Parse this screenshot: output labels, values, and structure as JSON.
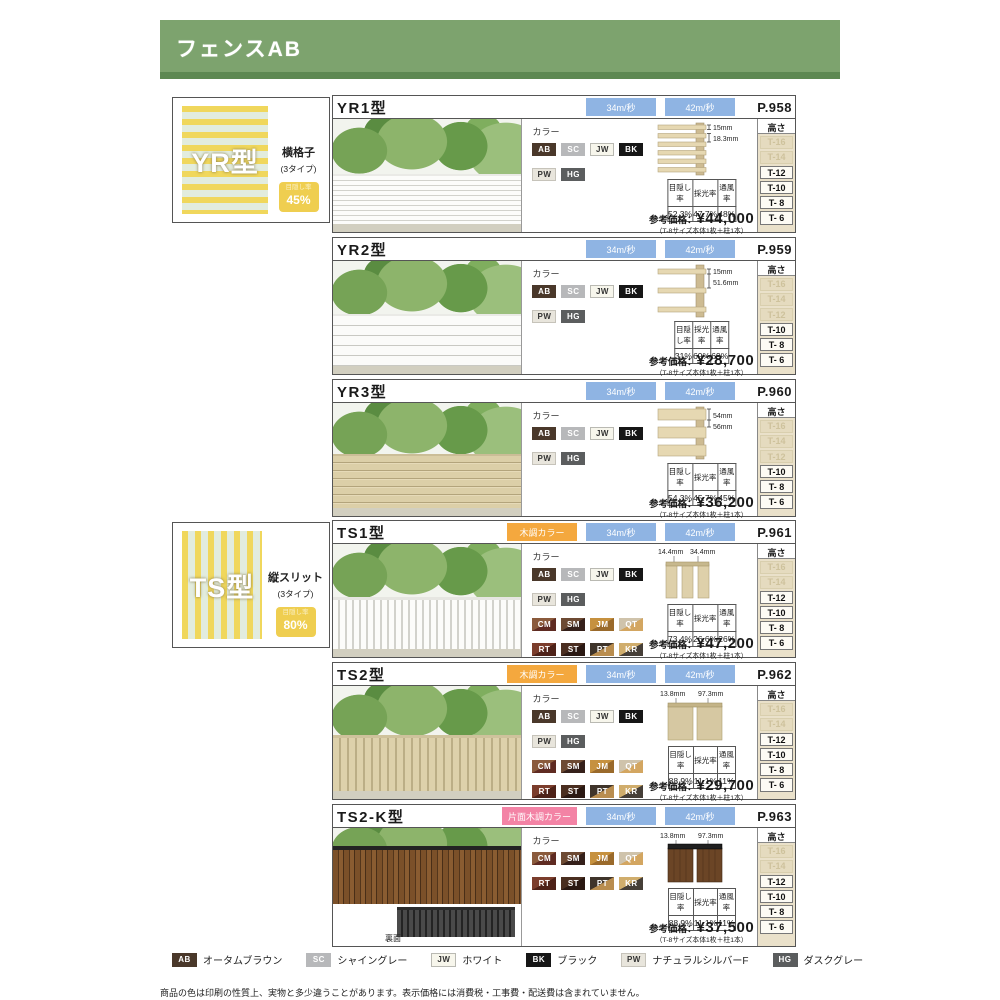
{
  "header": {
    "title": "フェンスAB"
  },
  "labels": {
    "color": "カラー",
    "height": "高さ",
    "price_label": "参考価格：",
    "price_note": "（T-8サイズ本体1枚＋柱1本）",
    "stats_headers": [
      "目隠し率",
      "採光率",
      "通風率"
    ],
    "back_label": "裏面"
  },
  "palette": {
    "banner_green": "#7da36e",
    "banner_green_dark": "#5d8852",
    "badge_blue": "#8fb4e3",
    "badge_orange": "#f4a83e",
    "badge_pink": "#f383a5",
    "rate_badge_yellow": "#efce50",
    "stripe_yellow": "#f0d75c",
    "stripe_mint": "#e2ecde",
    "height_col_beige": "#eae1ca"
  },
  "swatch_colors": {
    "AB": {
      "c1": "#4a382a",
      "text": "#ffffff"
    },
    "SC": {
      "c1": "#b7b8ba",
      "text": "#ffffff"
    },
    "JW": {
      "c1": "#f7f6ec",
      "text": "#333333",
      "border": "#b9b9b2"
    },
    "BK": {
      "c1": "#161616",
      "text": "#ffffff"
    },
    "PW": {
      "c1": "#e8e5dc",
      "text": "#333333",
      "border": "#c6c3ba"
    },
    "HG": {
      "c1": "#5b5d5e",
      "text": "#ffffff"
    },
    "CM": {
      "c1": "#8a5a3c",
      "c2": "#5f2b22",
      "text": "#ffffff"
    },
    "SM": {
      "c1": "#6d4a33",
      "c2": "#35201a",
      "text": "#ffffff"
    },
    "JM": {
      "c1": "#c6913f",
      "c2": "#9a6a2b",
      "text": "#ffffff"
    },
    "QT": {
      "c1": "#cfc3ab",
      "c2": "#d3a661",
      "text": "#ffffff"
    },
    "RT": {
      "c1": "#7b3d2c",
      "c2": "#4e2218",
      "text": "#ffffff"
    },
    "ST": {
      "c1": "#4a2e20",
      "c2": "#2a1812",
      "text": "#ffffff"
    },
    "PT": {
      "c1": "#3f342a",
      "c2": "#b98d4f",
      "text": "#ffffff"
    },
    "KR": {
      "c1": "#d0ad6c",
      "c2": "#463f38",
      "text": "#ffffff"
    }
  },
  "sections": [
    {
      "emblem": "YR型",
      "type_label": "横格子",
      "type_count": "(3タイプ)",
      "badge_title": "目隠し率",
      "badge_value": "45%"
    },
    {
      "emblem": "TS型",
      "type_label": "縦スリット",
      "type_count": "(3タイプ)",
      "badge_title": "目隠し率",
      "badge_value": "80%"
    }
  ],
  "rows": [
    {
      "model": "YR1型",
      "page": "P.958",
      "badges": [
        {
          "text": "34m/秒"
        },
        {
          "text": "42m/秒"
        }
      ],
      "swatches": [
        "AB",
        "SC",
        "JW",
        "BK",
        "PW",
        "HG"
      ],
      "dims": [
        "15mm",
        "18.3mm"
      ],
      "stats": [
        "52.3%",
        "47.7%",
        "48%"
      ],
      "price": "¥44,000",
      "heights": [
        {
          "label": "T-16",
          "on": false
        },
        {
          "label": "T-14",
          "on": false
        },
        {
          "label": "T-12",
          "on": true
        },
        {
          "label": "T-10",
          "on": true
        },
        {
          "label": "T- 8",
          "on": true
        },
        {
          "label": "T- 6",
          "on": true
        }
      ]
    },
    {
      "model": "YR2型",
      "page": "P.959",
      "badges": [
        {
          "text": "34m/秒"
        },
        {
          "text": "42m/秒"
        }
      ],
      "swatches": [
        "AB",
        "SC",
        "JW",
        "BK",
        "PW",
        "HG"
      ],
      "dims": [
        "15mm",
        "51.6mm"
      ],
      "stats": [
        "31%",
        "69%",
        "69%"
      ],
      "price": "¥28,700",
      "heights": [
        {
          "label": "T-16",
          "on": false
        },
        {
          "label": "T-14",
          "on": false
        },
        {
          "label": "T-12",
          "on": false
        },
        {
          "label": "T-10",
          "on": true
        },
        {
          "label": "T- 8",
          "on": true
        },
        {
          "label": "T- 6",
          "on": true
        }
      ]
    },
    {
      "model": "YR3型",
      "page": "P.960",
      "badges": [
        {
          "text": "34m/秒"
        },
        {
          "text": "42m/秒"
        }
      ],
      "swatches": [
        "AB",
        "SC",
        "JW",
        "BK",
        "PW",
        "HG"
      ],
      "dims": [
        "54mm",
        "56mm"
      ],
      "stats": [
        "54.3%",
        "45.7%",
        "45%"
      ],
      "price": "¥36,200",
      "heights": [
        {
          "label": "T-16",
          "on": false
        },
        {
          "label": "T-14",
          "on": false
        },
        {
          "label": "T-12",
          "on": false
        },
        {
          "label": "T-10",
          "on": true
        },
        {
          "label": "T- 8",
          "on": true
        },
        {
          "label": "T- 6",
          "on": true
        }
      ]
    },
    {
      "model": "TS1型",
      "page": "P.961",
      "badges": [
        {
          "text": "木調カラー"
        },
        {
          "text": "34m/秒"
        },
        {
          "text": "42m/秒"
        }
      ],
      "swatches": [
        "AB",
        "SC",
        "JW",
        "BK",
        "PW",
        "HG",
        "CM",
        "SM",
        "JM",
        "QT",
        "RT",
        "ST",
        "PT",
        "KR"
      ],
      "dims": [
        "14.4mm",
        "34.4mm"
      ],
      "stats": [
        "73.4%",
        "26.6%",
        "26%"
      ],
      "price": "¥47,200",
      "heights": [
        {
          "label": "T-16",
          "on": false
        },
        {
          "label": "T-14",
          "on": false
        },
        {
          "label": "T-12",
          "on": true
        },
        {
          "label": "T-10",
          "on": true
        },
        {
          "label": "T- 8",
          "on": true
        },
        {
          "label": "T- 6",
          "on": true
        }
      ]
    },
    {
      "model": "TS2型",
      "page": "P.962",
      "badges": [
        {
          "text": "木調カラー"
        },
        {
          "text": "34m/秒"
        },
        {
          "text": "42m/秒"
        }
      ],
      "swatches": [
        "AB",
        "SC",
        "JW",
        "BK",
        "PW",
        "HG",
        "CM",
        "SM",
        "JM",
        "QT",
        "RT",
        "ST",
        "PT",
        "KR"
      ],
      "dims": [
        "13.8mm",
        "97.3mm"
      ],
      "stats": [
        "88.9%",
        "11.1%",
        "11%"
      ],
      "price": "¥29,700",
      "heights": [
        {
          "label": "T-16",
          "on": false
        },
        {
          "label": "T-14",
          "on": false
        },
        {
          "label": "T-12",
          "on": true
        },
        {
          "label": "T-10",
          "on": true
        },
        {
          "label": "T- 8",
          "on": true
        },
        {
          "label": "T- 6",
          "on": true
        }
      ]
    },
    {
      "model": "TS2-K型",
      "page": "P.963",
      "badges": [
        {
          "text": "片面木調カラー"
        },
        {
          "text": "34m/秒"
        },
        {
          "text": "42m/秒"
        }
      ],
      "swatches": [
        "CM",
        "SM",
        "JM",
        "QT",
        "RT",
        "ST",
        "PT",
        "KR"
      ],
      "dims": [
        "13.8mm",
        "97.3mm"
      ],
      "stats": [
        "88.9%",
        "11.1%",
        "11%"
      ],
      "price": "¥37,500",
      "heights": [
        {
          "label": "T-16",
          "on": false
        },
        {
          "label": "T-14",
          "on": false
        },
        {
          "label": "T-12",
          "on": true
        },
        {
          "label": "T-10",
          "on": true
        },
        {
          "label": "T- 8",
          "on": true
        },
        {
          "label": "T- 6",
          "on": true
        }
      ]
    }
  ],
  "legend": [
    {
      "code": "AB",
      "name": "オータムブラウン"
    },
    {
      "code": "SC",
      "name": "シャイングレー"
    },
    {
      "code": "JW",
      "name": "ホワイト"
    },
    {
      "code": "BK",
      "name": "ブラック"
    },
    {
      "code": "PW",
      "name": "ナチュラルシルバーF"
    },
    {
      "code": "HG",
      "name": "ダスクグレー"
    }
  ],
  "footnote": "商品の色は印刷の性質上、実物と多少違うことがあります。表示価格には消費税・工事費・配送費は含まれていません。"
}
